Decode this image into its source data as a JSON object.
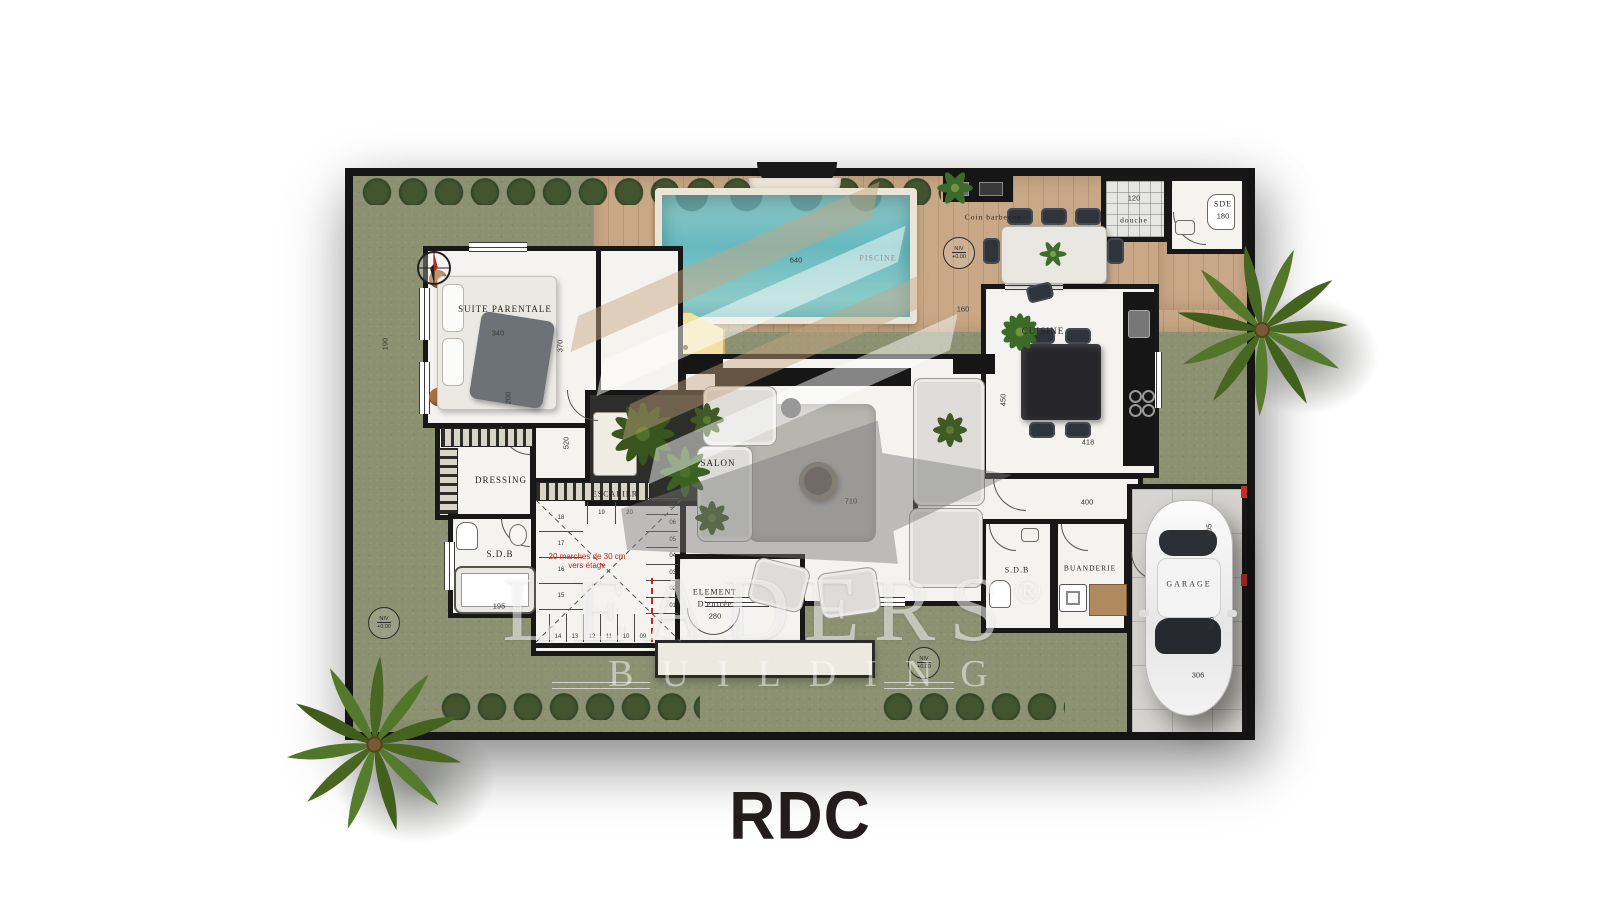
{
  "title": "RDC",
  "watermark": {
    "brand": "LEADERS",
    "reg": "®",
    "sub": "BUILDING"
  },
  "rooms": {
    "suite": "SUITE PARENTALE",
    "dressing": "DRESSING",
    "sdb1": "S.D.B",
    "escalier": "ESCALIER",
    "salon": "SALON",
    "cuisine": "CUISINE",
    "entree1": "ELEMENT",
    "entree2": "D'entrée",
    "sdb2": "S.D.B",
    "buanderie": "BUANDERIE",
    "garage": "GARAGE",
    "sde": "SDE",
    "douche": "douche",
    "barbecue": "Coin barbecue",
    "piscine": "PISCINE"
  },
  "dims": {
    "d955": "955",
    "d640": "640",
    "d160": "160",
    "d190": "190",
    "d340": "340",
    "d370": "370",
    "d200": "200",
    "d520": "520",
    "d195": "195",
    "d710": "710",
    "d450": "450",
    "d418": "418",
    "d400": "400",
    "d280": "280",
    "d120": "120",
    "d180": "180",
    "d905": "905",
    "d525": "525",
    "d306": "306"
  },
  "stairs": {
    "note1": "20 marches de 30 cm",
    "note2": "vers étage",
    "bottom": [
      "14",
      "13",
      "12",
      "11",
      "10",
      "09"
    ],
    "left": [
      "18",
      "17",
      "16",
      "15"
    ],
    "top": [
      "19",
      "20"
    ],
    "right": [
      "08",
      "07",
      "06",
      "05",
      "04",
      "03",
      "02",
      "01"
    ]
  },
  "level": {
    "l1": "NIV",
    "l2": "+0.00"
  }
}
